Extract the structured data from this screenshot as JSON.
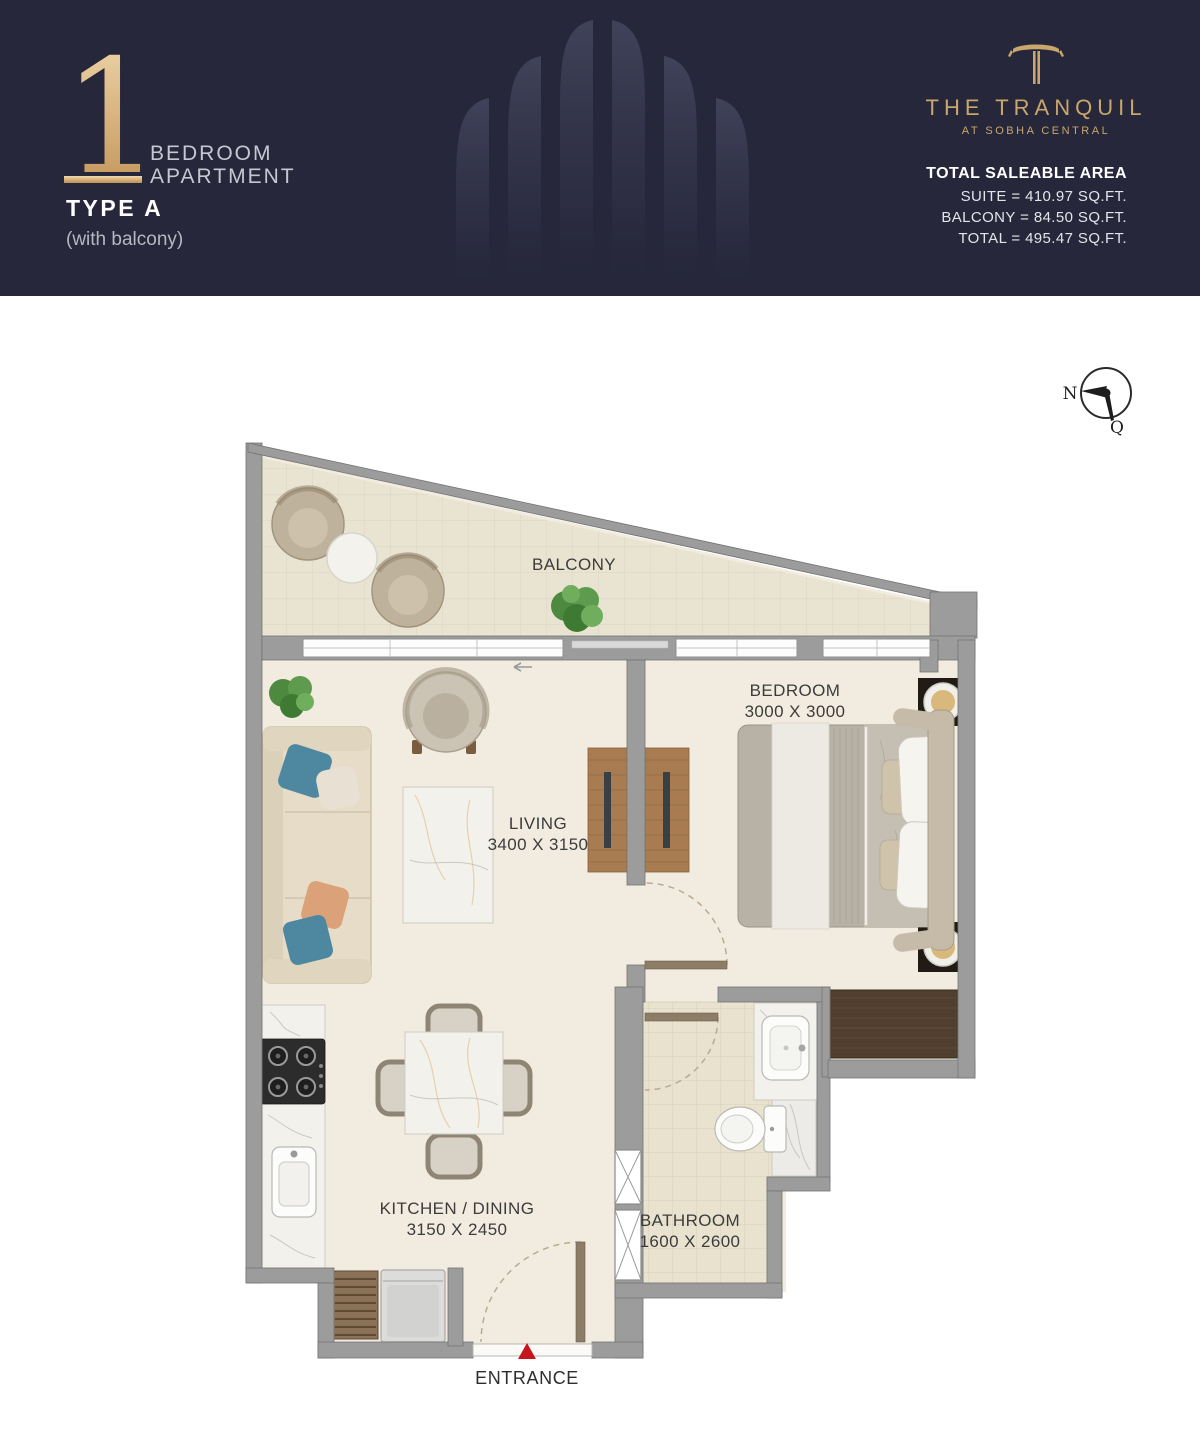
{
  "header": {
    "unit_number": "1",
    "unit_type_line1": "BEDROOM",
    "unit_type_line2": "APARTMENT",
    "type_label": "TYPE A",
    "type_note": "(with balcony)",
    "brand": {
      "logo": "T-monogram",
      "name": "THE TRANQUIL",
      "subtitle": "AT SOBHA CENTRAL"
    },
    "area": {
      "title": "TOTAL SALEABLE AREA",
      "lines": [
        "SUITE = 410.97 SQ.FT.",
        "BALCONY = 84.50 SQ.FT.",
        "TOTAL = 495.47 SQ.FT."
      ]
    },
    "colors": {
      "background": "#26273a",
      "gold": "#c9a66b",
      "text_light": "#c6c7d1",
      "text_white": "#ffffff"
    }
  },
  "compass": {
    "north_label": "N",
    "qibla_label": "Q"
  },
  "floorplan": {
    "labels": {
      "balcony": "BALCONY",
      "living": "LIVING",
      "living_dims": "3400 X 3150",
      "bedroom": "BEDROOM",
      "bedroom_dims": "3000 X 3000",
      "kitchen": "KITCHEN / DINING",
      "kitchen_dims": "3150 X 2450",
      "bathroom": "BATHROOM",
      "bathroom_dims": "1600 X 2600",
      "entrance": "ENTRANCE"
    },
    "colors": {
      "wall": "#9c9c9c",
      "floor": "#f2ece0",
      "balcony_floor": "#e9e4d2",
      "bathroom_floor": "#e8e2cf",
      "entrance_arrow": "#c4161c",
      "label_text": "#3c3c3c"
    }
  }
}
